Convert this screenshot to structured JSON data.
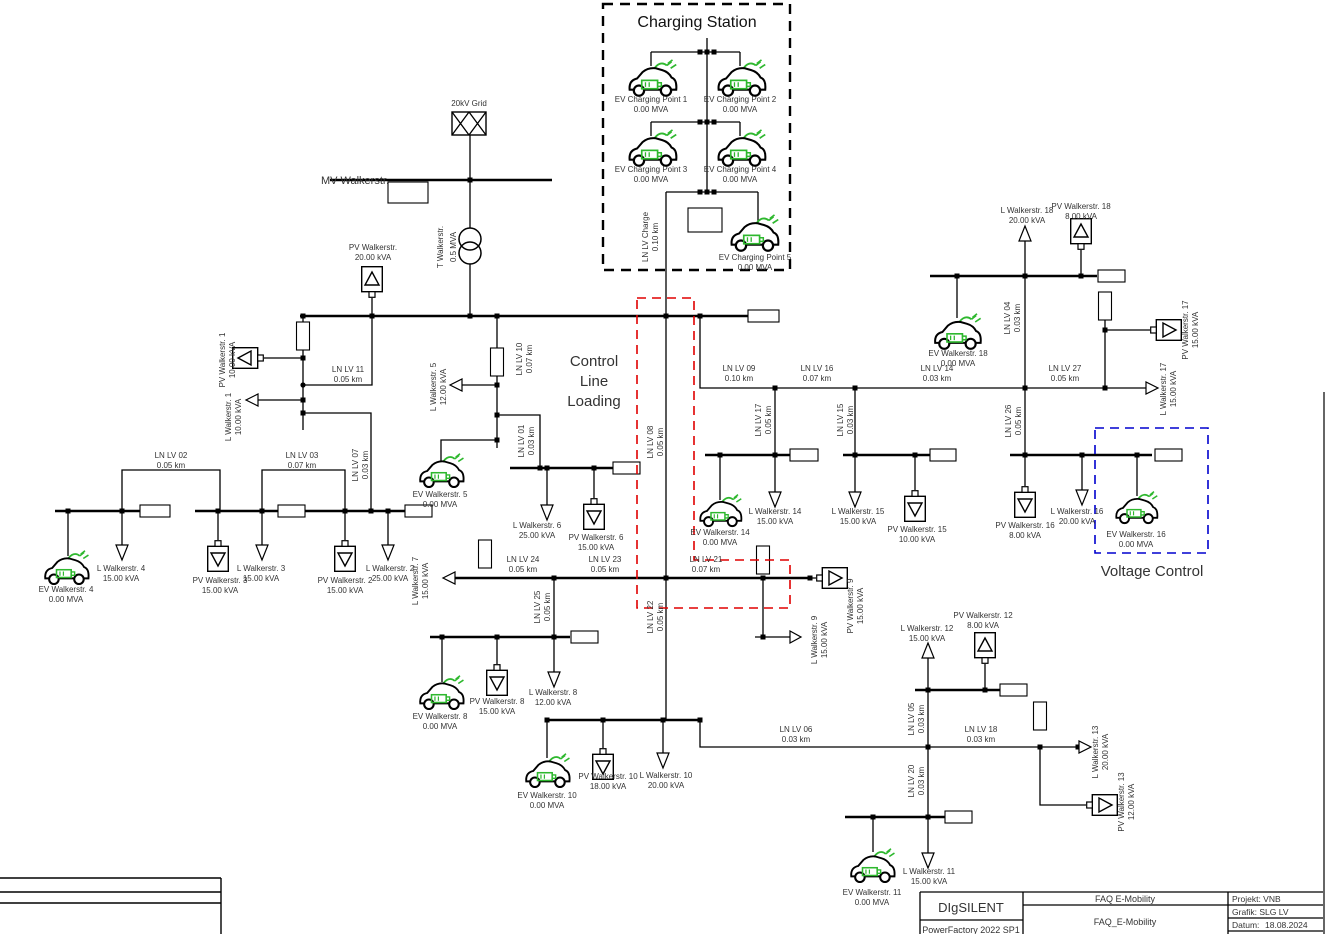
{
  "annotations": {
    "charging_station": "Charging Station",
    "control_line1": "Control",
    "control_line2": "Line",
    "control_line3": "Loading",
    "voltage_control": "Voltage Control"
  },
  "colors": {
    "ev_green": "#2eb82e",
    "control_red": "#e00000",
    "voltage_blue": "#0000cd"
  },
  "source": {
    "name": "20kV Grid"
  },
  "mv_bus": {
    "name": "MV Walkerstr."
  },
  "transformer": {
    "name": "T Walkerstr.",
    "rating": "0.5 MVA"
  },
  "charging_points": {
    "cp1": {
      "name": "EV Charging Point 1",
      "rating": "0.00 MVA"
    },
    "cp2": {
      "name": "EV Charging Point 2",
      "rating": "0.00 MVA"
    },
    "cp3": {
      "name": "EV Charging Point 3",
      "rating": "0.00 MVA"
    },
    "cp4": {
      "name": "EV Charging Point 4",
      "rating": "0.00 MVA"
    },
    "cp5": {
      "name": "EV Charging Point 5",
      "rating": "0.00 MVA"
    }
  },
  "lines": {
    "charge": {
      "name": "LN LV Charge",
      "len": "0.10 km"
    },
    "l01": {
      "name": "LN LV 01",
      "len": "0.03 km"
    },
    "l02": {
      "name": "LN LV 02",
      "len": "0.05 km"
    },
    "l03": {
      "name": "LN LV 03",
      "len": "0.07 km"
    },
    "l04": {
      "name": "LN LV 04",
      "len": "0.03 km"
    },
    "l05": {
      "name": "LN LV 05",
      "len": "0.03 km"
    },
    "l06": {
      "name": "LN LV 06",
      "len": "0.03 km"
    },
    "l07": {
      "name": "LN LV 07",
      "len": "0.03 km"
    },
    "l08": {
      "name": "LN LV 08",
      "len": "0.05 km"
    },
    "l09": {
      "name": "LN LV 09",
      "len": "0.10 km"
    },
    "l10": {
      "name": "LN LV 10",
      "len": "0.07 km"
    },
    "l11": {
      "name": "LN LV 11",
      "len": "0.05 km"
    },
    "l14": {
      "name": "LN LV 14",
      "len": "0.03 km"
    },
    "l15": {
      "name": "LN LV 15",
      "len": "0.03 km"
    },
    "l16": {
      "name": "LN LV 16",
      "len": "0.07 km"
    },
    "l17": {
      "name": "LN LV 17",
      "len": "0.05 km"
    },
    "l18": {
      "name": "LN LV 18",
      "len": "0.03 km"
    },
    "l20": {
      "name": "LN LV 20",
      "len": "0.03 km"
    },
    "l21": {
      "name": "LN LV 21",
      "len": "0.07 km"
    },
    "l22": {
      "name": "LN LV 22",
      "len": "0.05 km"
    },
    "l23": {
      "name": "LN LV 23",
      "len": "0.05 km"
    },
    "l24": {
      "name": "LN LV 24",
      "len": "0.05 km"
    },
    "l25": {
      "name": "LN LV 25",
      "len": "0.05 km"
    },
    "l26": {
      "name": "LN LV 26",
      "len": "0.05 km"
    },
    "l27": {
      "name": "LN LV 27",
      "len": "0.05 km"
    }
  },
  "loads": {
    "w1": {
      "name": "L Walkerstr. 1",
      "rating": "10.00 kVA"
    },
    "w2": {
      "name": "L Walkerstr. 2",
      "rating": "25.00 kVA"
    },
    "w3": {
      "name": "L Walkerstr. 3",
      "rating": "15.00 kVA"
    },
    "w4": {
      "name": "L Walkerstr. 4",
      "rating": "15.00 kVA"
    },
    "w5": {
      "name": "L Walkerstr. 5",
      "rating": "12.00 kVA"
    },
    "w6": {
      "name": "L Walkerstr. 6",
      "rating": "25.00 kVA"
    },
    "w7": {
      "name": "L Walkerstr. 7",
      "rating": "15.00 kVA"
    },
    "w8": {
      "name": "L Walkerstr. 8",
      "rating": "12.00 kVA"
    },
    "w9": {
      "name": "L Walkerstr. 9",
      "rating": "15.00 kVA"
    },
    "w10": {
      "name": "L Walkerstr. 10",
      "rating": "20.00 kVA"
    },
    "w11": {
      "name": "L Walkerstr. 11",
      "rating": "15.00 kVA"
    },
    "w12": {
      "name": "L Walkerstr. 12",
      "rating": "15.00 kVA"
    },
    "w13": {
      "name": "L Walkerstr. 13",
      "rating": "20.00 kVA"
    },
    "w14": {
      "name": "L Walkerstr. 14",
      "rating": "15.00 kVA"
    },
    "w15": {
      "name": "L Walkerstr. 15",
      "rating": "15.00 kVA"
    },
    "w16": {
      "name": "L Walkerstr. 16",
      "rating": "20.00 kVA"
    },
    "w17": {
      "name": "L Walkerstr. 17",
      "rating": "15.00 kVA"
    },
    "w18": {
      "name": "L Walkerstr. 18",
      "rating": "20.00 kVA"
    }
  },
  "pv": {
    "main": {
      "name": "PV Walkerstr.",
      "rating": "20.00 kVA"
    },
    "w1": {
      "name": "PV Walkerstr. 1",
      "rating": "10.00 kVA"
    },
    "w2": {
      "name": "PV Walkerstr. 2",
      "rating": "15.00 kVA"
    },
    "w3": {
      "name": "PV Walkerstr. 3",
      "rating": "15.00 kVA"
    },
    "w6": {
      "name": "PV Walkerstr. 6",
      "rating": "15.00 kVA"
    },
    "w8": {
      "name": "PV Walkerstr. 8",
      "rating": "15.00 kVA"
    },
    "w9": {
      "name": "PV Walkerstr. 9",
      "rating": "15.00 kVA"
    },
    "w10": {
      "name": "PV Walkerstr. 10",
      "rating": "18.00 kVA"
    },
    "w12": {
      "name": "PV Walkerstr. 12",
      "rating": "8.00 kVA"
    },
    "w13": {
      "name": "PV Walkerstr. 13",
      "rating": "12.00 kVA"
    },
    "w15": {
      "name": "PV Walkerstr. 15",
      "rating": "10.00 kVA"
    },
    "w16": {
      "name": "PV Walkerstr. 16",
      "rating": "8.00 kVA"
    },
    "w17": {
      "name": "PV Walkerstr. 17",
      "rating": "15.00 kVA"
    },
    "w18": {
      "name": "PV Walkerstr. 18",
      "rating": "8.00 kVA"
    }
  },
  "ev": {
    "w4": {
      "name": "EV Walkerstr. 4",
      "rating": "0.00 MVA"
    },
    "w5": {
      "name": "EV Walkerstr. 5",
      "rating": "0.00 MVA"
    },
    "w8": {
      "name": "EV Walkerstr. 8",
      "rating": "0.00 MVA"
    },
    "w10": {
      "name": "EV Walkerstr. 10",
      "rating": "0.00 MVA"
    },
    "w11": {
      "name": "EV Walkerstr. 11",
      "rating": "0.00 MVA"
    },
    "w14": {
      "name": "EV Walkerstr. 14",
      "rating": "0.00 MVA"
    },
    "w16": {
      "name": "EV Walkerstr. 16",
      "rating": "0.00 MVA"
    },
    "w18": {
      "name": "EV Walkerstr. 18",
      "rating": "0.00 MVA"
    }
  },
  "title_block": {
    "vendor": "DIgSILENT",
    "product": "PowerFactory 2022 SP1",
    "project_title": "FAQ E-Mobility",
    "graphic_title": "FAQ_E-Mobility",
    "project": "Projekt: VNB",
    "graphic": "Grafik: SLG LV",
    "date_label": "Datum:",
    "date": "18.08.2024"
  }
}
